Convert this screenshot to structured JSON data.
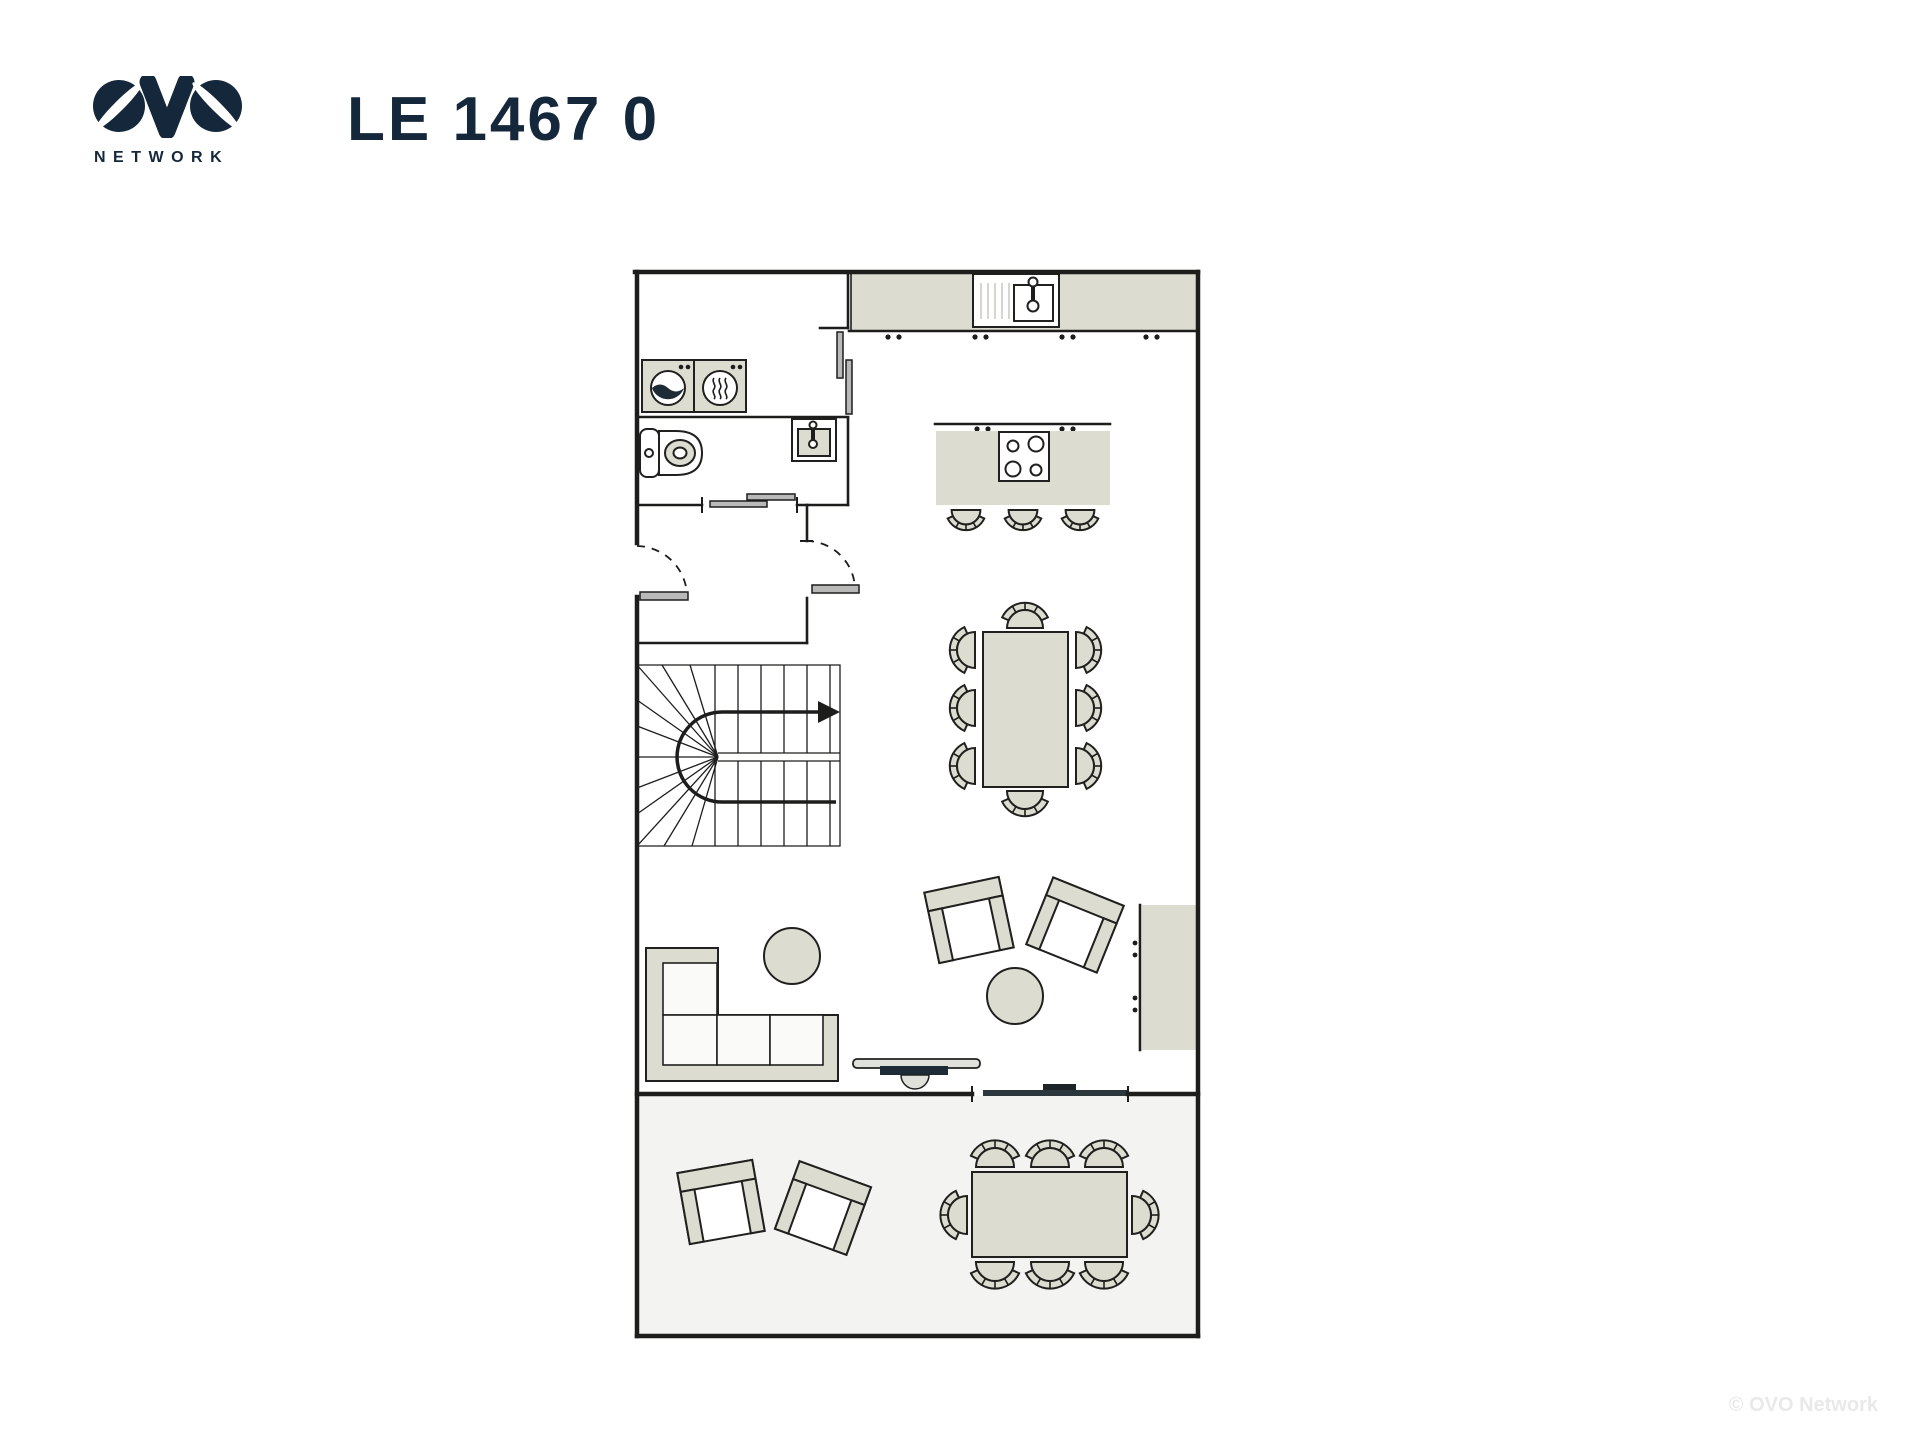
{
  "header": {
    "logo_text": "OVO",
    "logo_subtext": "NETWORK",
    "title": "LE 1467 0"
  },
  "watermark": {
    "text": "© OVO Network"
  },
  "colors": {
    "ink": "#15273a",
    "wall": "#1d1d1b",
    "furniture_fill": "#dcddd0",
    "furniture_stroke": "#20201e",
    "terrace_fill": "#f3f4f1",
    "door_slider": "#b9b9b9",
    "dark_slider": "#2c363d",
    "watermark": "#e9e9e9",
    "appliance_dark": "#1d2b36",
    "tv_light": "#dfe1da"
  },
  "floorplan": {
    "type": "apartment-ground-floor",
    "rooms": [
      {
        "name": "laundry",
        "furniture": [
          "washing-machine",
          "tumble-dryer"
        ]
      },
      {
        "name": "wc",
        "furniture": [
          "toilet",
          "hand-basin"
        ],
        "doors": [
          "sliding-door"
        ]
      },
      {
        "name": "hall",
        "furniture": [
          "u-shaped-staircase"
        ],
        "doors": [
          "entry-swing-door",
          "swing-door-to-living"
        ]
      },
      {
        "name": "kitchen-living",
        "furniture": [
          "wall-counter-with-sink",
          "island-with-hob",
          "3-bar-stools",
          "dining-table-8-chairs",
          "l-shaped-sofa",
          "round-coffee-table",
          "2-armchairs",
          "round-side-table",
          "tv-console",
          "sideboard"
        ]
      },
      {
        "name": "terrace",
        "furniture": [
          "2-outdoor-armchairs",
          "outdoor-dining-table-8-chairs"
        ],
        "doors": [
          "sliding-glass-door"
        ]
      }
    ]
  }
}
